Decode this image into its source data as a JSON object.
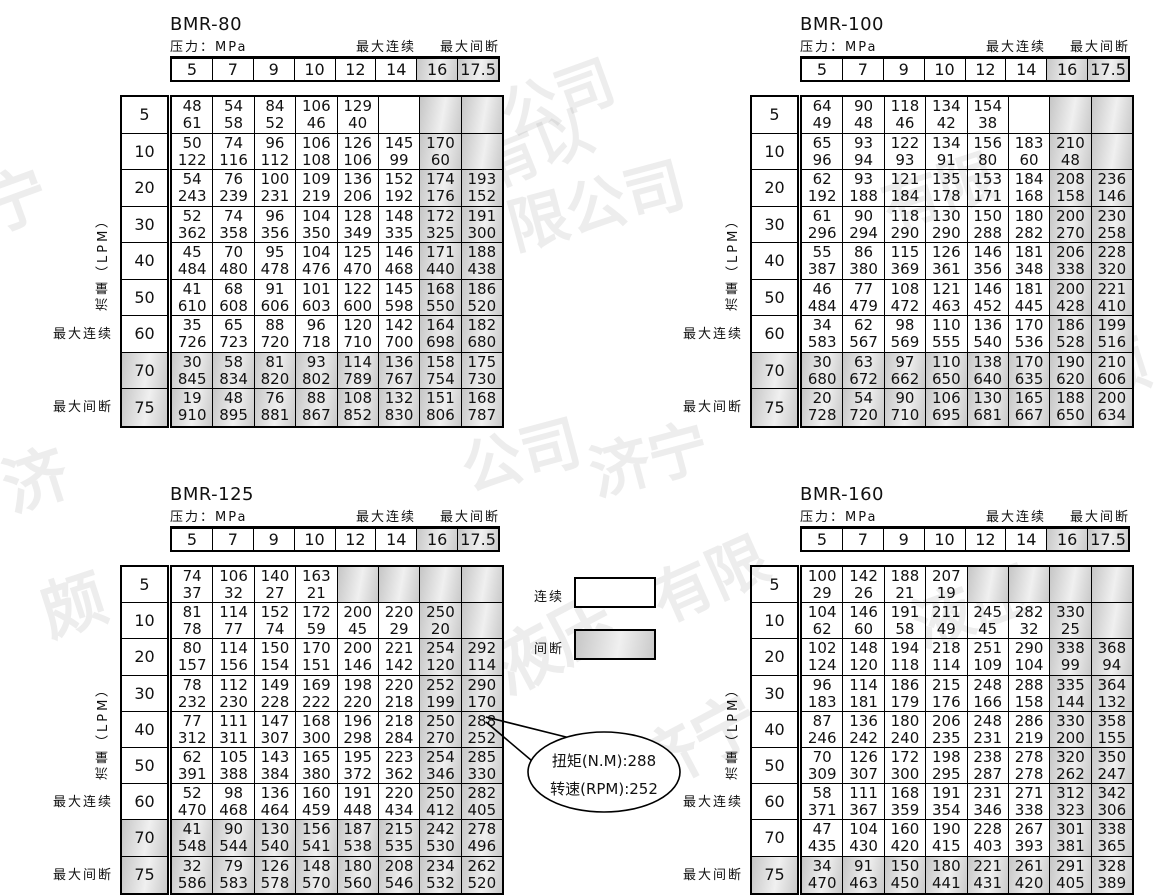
{
  "labels": {
    "pressure": "压力：MPa",
    "max_continuous": "最大连续",
    "max_intermittent": "最大间断",
    "flow": "流量（LPM）"
  },
  "legend": {
    "continuous": "连续",
    "intermittent": "间断"
  },
  "callout": {
    "line1": "扭矩(N.M):288",
    "line2": "转速(RPM):252"
  },
  "shared": {
    "pressure_values": [
      "5",
      "7",
      "9",
      "10",
      "12",
      "14",
      "16",
      "17.5"
    ],
    "flow_values": [
      "5",
      "10",
      "20",
      "30",
      "40",
      "50",
      "60",
      "70",
      "75"
    ]
  },
  "colors": {
    "grid": "#000000",
    "gray_fill": "#cccccc",
    "text": "#111111"
  },
  "tables": [
    {
      "title": "BMR-80",
      "gray_rows": [
        7,
        8
      ],
      "cells": [
        [
          [
            48,
            61
          ],
          [
            54,
            58
          ],
          [
            84,
            52
          ],
          [
            106,
            46
          ],
          [
            129,
            40
          ],
          null,
          "g",
          "g"
        ],
        [
          [
            50,
            122
          ],
          [
            74,
            116
          ],
          [
            96,
            112
          ],
          [
            106,
            108
          ],
          [
            126,
            106
          ],
          [
            145,
            99
          ],
          [
            170,
            60
          ],
          "g"
        ],
        [
          [
            54,
            243
          ],
          [
            76,
            239
          ],
          [
            100,
            231
          ],
          [
            109,
            219
          ],
          [
            136,
            206
          ],
          [
            152,
            192
          ],
          [
            174,
            176
          ],
          [
            193,
            152
          ]
        ],
        [
          [
            52,
            362
          ],
          [
            74,
            358
          ],
          [
            96,
            356
          ],
          [
            104,
            350
          ],
          [
            128,
            349
          ],
          [
            148,
            335
          ],
          [
            172,
            325
          ],
          [
            191,
            300
          ]
        ],
        [
          [
            45,
            484
          ],
          [
            70,
            480
          ],
          [
            95,
            478
          ],
          [
            104,
            476
          ],
          [
            125,
            470
          ],
          [
            146,
            468
          ],
          [
            171,
            440
          ],
          [
            188,
            438
          ]
        ],
        [
          [
            41,
            610
          ],
          [
            68,
            608
          ],
          [
            91,
            606
          ],
          [
            101,
            603
          ],
          [
            122,
            600
          ],
          [
            145,
            598
          ],
          [
            168,
            550
          ],
          [
            186,
            520
          ]
        ],
        [
          [
            35,
            726
          ],
          [
            65,
            723
          ],
          [
            88,
            720
          ],
          [
            96,
            718
          ],
          [
            120,
            710
          ],
          [
            142,
            700
          ],
          [
            164,
            698
          ],
          [
            182,
            680
          ]
        ],
        [
          [
            30,
            845
          ],
          [
            58,
            834
          ],
          [
            81,
            820
          ],
          [
            93,
            802
          ],
          [
            114,
            789
          ],
          [
            136,
            767
          ],
          [
            158,
            754
          ],
          [
            175,
            730
          ]
        ],
        [
          [
            19,
            910
          ],
          [
            48,
            895
          ],
          [
            76,
            881
          ],
          [
            88,
            867
          ],
          [
            108,
            852
          ],
          [
            132,
            830
          ],
          [
            151,
            806
          ],
          [
            168,
            787
          ]
        ]
      ]
    },
    {
      "title": "BMR-100",
      "gray_rows": [
        7,
        8
      ],
      "cells": [
        [
          [
            64,
            49
          ],
          [
            90,
            48
          ],
          [
            118,
            46
          ],
          [
            134,
            42
          ],
          [
            154,
            38
          ],
          null,
          "g",
          "g"
        ],
        [
          [
            65,
            96
          ],
          [
            93,
            94
          ],
          [
            122,
            93
          ],
          [
            134,
            91
          ],
          [
            156,
            80
          ],
          [
            183,
            60
          ],
          [
            210,
            48
          ],
          "g"
        ],
        [
          [
            62,
            192
          ],
          [
            93,
            188
          ],
          [
            121,
            184
          ],
          [
            135,
            178
          ],
          [
            153,
            171
          ],
          [
            184,
            168
          ],
          [
            208,
            158
          ],
          [
            236,
            146
          ]
        ],
        [
          [
            61,
            296
          ],
          [
            90,
            294
          ],
          [
            118,
            290
          ],
          [
            130,
            290
          ],
          [
            150,
            288
          ],
          [
            180,
            282
          ],
          [
            200,
            270
          ],
          [
            230,
            258
          ]
        ],
        [
          [
            55,
            387
          ],
          [
            86,
            380
          ],
          [
            115,
            369
          ],
          [
            126,
            361
          ],
          [
            146,
            356
          ],
          [
            181,
            348
          ],
          [
            206,
            338
          ],
          [
            228,
            320
          ]
        ],
        [
          [
            46,
            484
          ],
          [
            77,
            479
          ],
          [
            108,
            472
          ],
          [
            121,
            463
          ],
          [
            146,
            452
          ],
          [
            181,
            445
          ],
          [
            200,
            428
          ],
          [
            221,
            410
          ]
        ],
        [
          [
            34,
            583
          ],
          [
            62,
            567
          ],
          [
            98,
            569
          ],
          [
            110,
            555
          ],
          [
            136,
            540
          ],
          [
            170,
            536
          ],
          [
            186,
            528
          ],
          [
            199,
            516
          ]
        ],
        [
          [
            30,
            680
          ],
          [
            63,
            672
          ],
          [
            97,
            662
          ],
          [
            110,
            650
          ],
          [
            138,
            640
          ],
          [
            170,
            635
          ],
          [
            190,
            620
          ],
          [
            210,
            606
          ]
        ],
        [
          [
            20,
            728
          ],
          [
            54,
            720
          ],
          [
            90,
            710
          ],
          [
            106,
            695
          ],
          [
            130,
            681
          ],
          [
            165,
            667
          ],
          [
            188,
            650
          ],
          [
            200,
            634
          ]
        ]
      ]
    },
    {
      "title": "BMR-125",
      "gray_rows": [
        7,
        8
      ],
      "cells": [
        [
          [
            74,
            37
          ],
          [
            106,
            32
          ],
          [
            140,
            27
          ],
          [
            163,
            21
          ],
          "g",
          "g",
          "g",
          "g"
        ],
        [
          [
            81,
            78
          ],
          [
            114,
            77
          ],
          [
            152,
            74
          ],
          [
            172,
            59
          ],
          [
            200,
            45
          ],
          [
            220,
            29
          ],
          [
            250,
            20
          ],
          "g"
        ],
        [
          [
            80,
            157
          ],
          [
            114,
            156
          ],
          [
            150,
            154
          ],
          [
            170,
            151
          ],
          [
            200,
            146
          ],
          [
            221,
            142
          ],
          [
            254,
            120
          ],
          [
            292,
            114
          ]
        ],
        [
          [
            78,
            232
          ],
          [
            112,
            230
          ],
          [
            149,
            228
          ],
          [
            169,
            222
          ],
          [
            198,
            220
          ],
          [
            220,
            218
          ],
          [
            252,
            199
          ],
          [
            290,
            170
          ]
        ],
        [
          [
            77,
            312
          ],
          [
            111,
            311
          ],
          [
            147,
            307
          ],
          [
            168,
            300
          ],
          [
            196,
            298
          ],
          [
            218,
            284
          ],
          [
            250,
            270
          ],
          [
            288,
            252
          ]
        ],
        [
          [
            62,
            391
          ],
          [
            105,
            388
          ],
          [
            143,
            384
          ],
          [
            165,
            380
          ],
          [
            195,
            372
          ],
          [
            223,
            362
          ],
          [
            254,
            346
          ],
          [
            285,
            330
          ]
        ],
        [
          [
            52,
            470
          ],
          [
            98,
            468
          ],
          [
            136,
            464
          ],
          [
            160,
            459
          ],
          [
            191,
            448
          ],
          [
            220,
            434
          ],
          [
            250,
            412
          ],
          [
            282,
            405
          ]
        ],
        [
          [
            41,
            548
          ],
          [
            90,
            544
          ],
          [
            130,
            540
          ],
          [
            156,
            541
          ],
          [
            187,
            538
          ],
          [
            215,
            535
          ],
          [
            242,
            530
          ],
          [
            278,
            496
          ]
        ],
        [
          [
            32,
            586
          ],
          [
            79,
            583
          ],
          [
            126,
            578
          ],
          [
            148,
            570
          ],
          [
            180,
            560
          ],
          [
            208,
            546
          ],
          [
            234,
            532
          ],
          [
            262,
            520
          ]
        ]
      ]
    },
    {
      "title": "BMR-160",
      "gray_rows": [
        8
      ],
      "cells": [
        [
          [
            100,
            29
          ],
          [
            142,
            26
          ],
          [
            188,
            21
          ],
          [
            207,
            19
          ],
          "g",
          "g",
          "g",
          "g"
        ],
        [
          [
            104,
            62
          ],
          [
            146,
            60
          ],
          [
            191,
            58
          ],
          [
            211,
            49
          ],
          [
            245,
            45
          ],
          [
            282,
            32
          ],
          [
            330,
            25
          ],
          "g"
        ],
        [
          [
            102,
            124
          ],
          [
            148,
            120
          ],
          [
            194,
            118
          ],
          [
            218,
            114
          ],
          [
            251,
            109
          ],
          [
            290,
            104
          ],
          [
            338,
            99
          ],
          [
            368,
            94
          ]
        ],
        [
          [
            96,
            183
          ],
          [
            114,
            181
          ],
          [
            186,
            179
          ],
          [
            215,
            176
          ],
          [
            248,
            166
          ],
          [
            288,
            158
          ],
          [
            335,
            144
          ],
          [
            364,
            132
          ]
        ],
        [
          [
            87,
            246
          ],
          [
            136,
            242
          ],
          [
            180,
            240
          ],
          [
            206,
            235
          ],
          [
            248,
            231
          ],
          [
            286,
            219
          ],
          [
            330,
            200
          ],
          [
            358,
            155
          ]
        ],
        [
          [
            70,
            309
          ],
          [
            126,
            307
          ],
          [
            172,
            300
          ],
          [
            198,
            295
          ],
          [
            238,
            287
          ],
          [
            278,
            278
          ],
          [
            320,
            262
          ],
          [
            350,
            247
          ]
        ],
        [
          [
            58,
            371
          ],
          [
            111,
            367
          ],
          [
            168,
            359
          ],
          [
            191,
            354
          ],
          [
            231,
            346
          ],
          [
            271,
            338
          ],
          [
            312,
            323
          ],
          [
            342,
            306
          ]
        ],
        [
          [
            47,
            435
          ],
          [
            104,
            430
          ],
          [
            160,
            420
          ],
          [
            190,
            415
          ],
          [
            228,
            403
          ],
          [
            267,
            393
          ],
          [
            301,
            381
          ],
          [
            338,
            365
          ]
        ],
        [
          [
            34,
            470
          ],
          [
            91,
            463
          ],
          [
            150,
            450
          ],
          [
            180,
            441
          ],
          [
            221,
            431
          ],
          [
            261,
            420
          ],
          [
            291,
            405
          ],
          [
            328,
            389
          ]
        ]
      ]
    }
  ],
  "watermarks": [
    {
      "text": "公司",
      "x": 498,
      "y": 52,
      "rot": -20,
      "size": 58
    },
    {
      "text": "有限",
      "x": 880,
      "y": 145,
      "rot": -18,
      "size": 58
    },
    {
      "text": "限公司",
      "x": 505,
      "y": 158,
      "rot": -15,
      "size": 60
    },
    {
      "text": "宁",
      "x": -18,
      "y": 150,
      "rot": -20,
      "size": 64
    },
    {
      "text": "济",
      "x": 2,
      "y": 430,
      "rot": -18,
      "size": 64
    },
    {
      "text": "公司",
      "x": 460,
      "y": 408,
      "rot": -15,
      "size": 60
    },
    {
      "text": "济宁",
      "x": 588,
      "y": 412,
      "rot": -15,
      "size": 60
    },
    {
      "text": "颇",
      "x": 40,
      "y": 555,
      "rot": -18,
      "size": 64
    },
    {
      "text": "液压",
      "x": 486,
      "y": 592,
      "rot": -28,
      "size": 66
    },
    {
      "text": "有限",
      "x": 648,
      "y": 532,
      "rot": -24,
      "size": 60
    },
    {
      "text": "颇",
      "x": 1085,
      "y": 320,
      "rot": -18,
      "size": 62
    },
    {
      "text": "济宁",
      "x": 628,
      "y": 692,
      "rot": -28,
      "size": 66
    },
    {
      "text": "液压",
      "x": 910,
      "y": 560,
      "rot": -20,
      "size": 60
    },
    {
      "text": "有以",
      "x": 480,
      "y": 105,
      "rot": -22,
      "size": 56
    }
  ]
}
